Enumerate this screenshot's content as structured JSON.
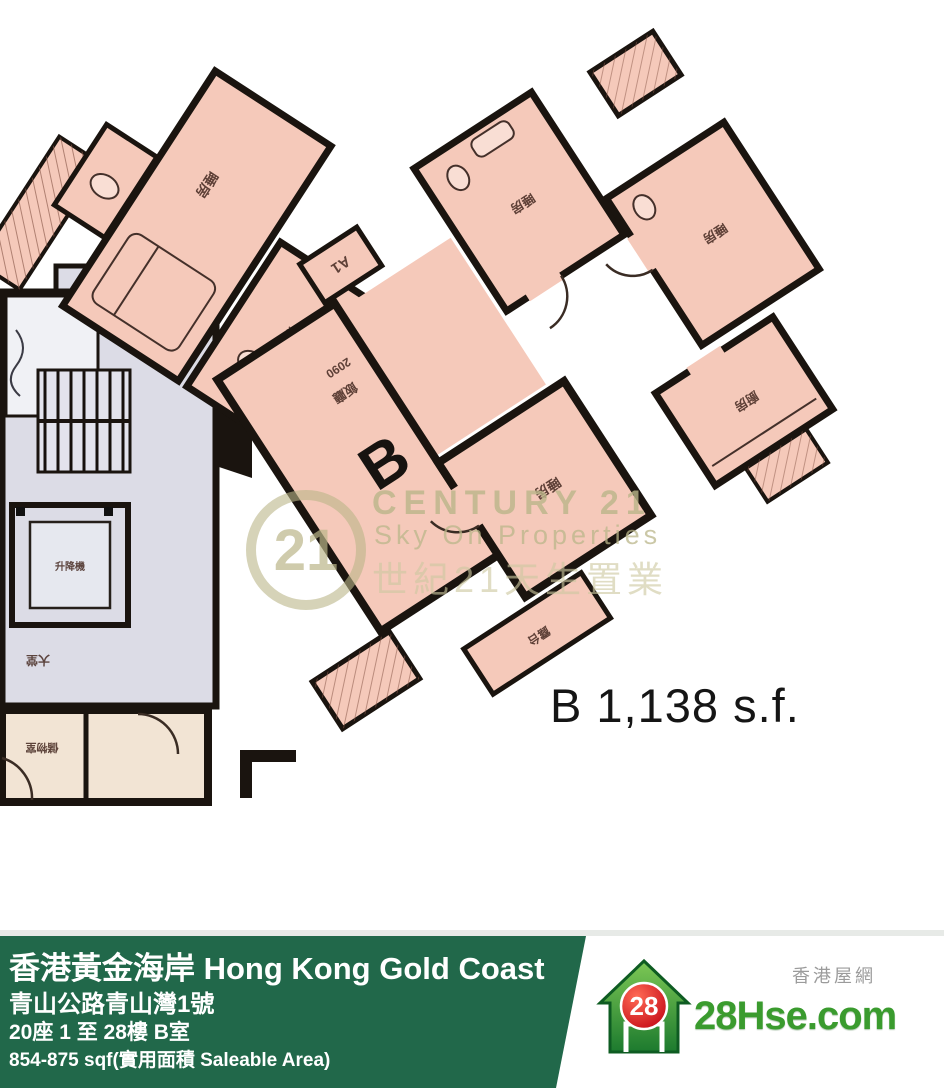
{
  "colors": {
    "room_fill": "#f5c9ba",
    "wall": "#1a140f",
    "core_fill": "#dcdce6",
    "beige_fill": "#f2e4d4",
    "watermark_khaki": "#bab589",
    "footer_green": "#21684a",
    "logo_green": "#3a9b2e",
    "logo_red": "#d41020",
    "area_text_color": "#151515"
  },
  "plan": {
    "unit_letter": "B",
    "area_text": "B 1,138 s.f.",
    "flat_tag": "A1",
    "labels": {
      "bedroom_a": "睡房",
      "bath_a": "浴室",
      "dining_dim": "2090",
      "dining": "飯廳",
      "bedroom_b1": "睡房",
      "bedroom_b2": "睡房",
      "kitchen": "廚房",
      "master": "睡房",
      "balcony": "露台",
      "lift": "升降機",
      "lobby": "大堂",
      "store": "儲物室"
    }
  },
  "watermark": {
    "logo_number": "21",
    "brand": "CENTURY 21",
    "agency_en": "Sky On Properties",
    "agency_zh": "世紀21天生置業"
  },
  "footer": {
    "title": "香港黃金海岸 Hong Kong Gold Coast",
    "address": "青山公路青山灣1號",
    "block_floor_unit": "20座 1 至 28樓 B室",
    "saleable_area": "854-875 sqf(實用面積 Saleable Area)"
  },
  "logo": {
    "badge": "28",
    "site": "28Hse.com",
    "tagline": "香港屋網"
  }
}
